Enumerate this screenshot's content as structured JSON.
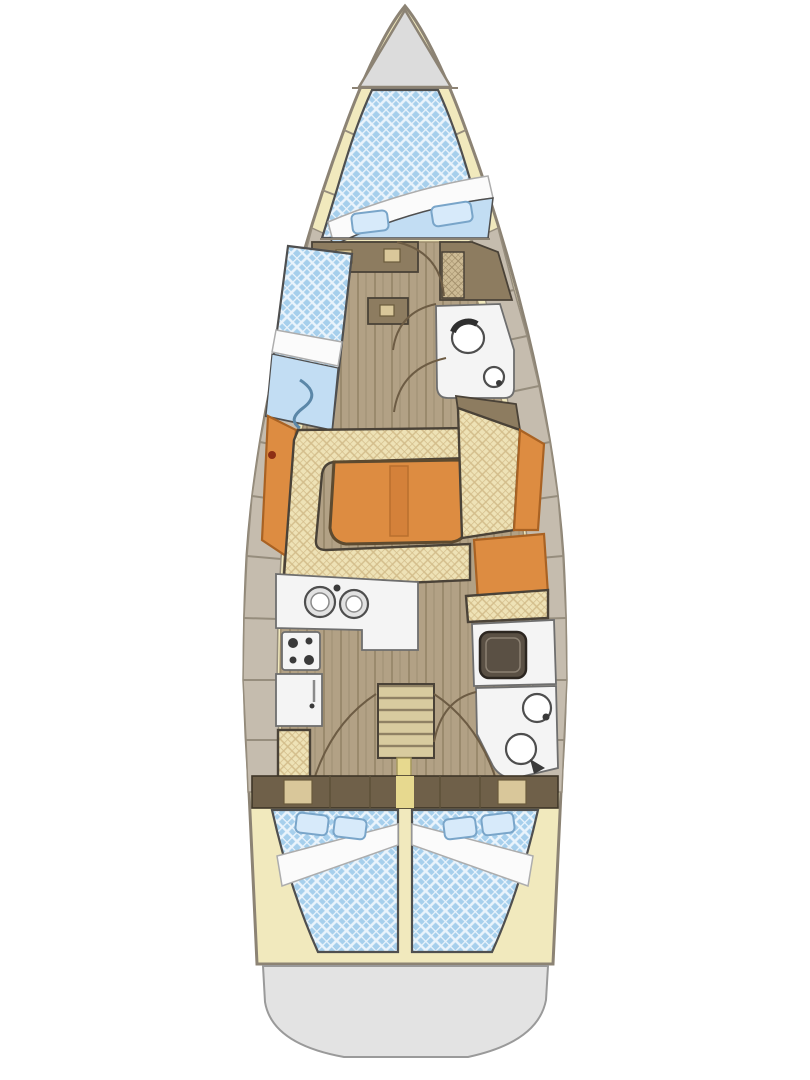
{
  "document": {
    "kind": "sailboat-interior-floor-plan",
    "orientation": "bow-up",
    "visible_text": []
  },
  "colors": {
    "deck_yellow": "#f1e9bd",
    "hull_outline": "#8c8374",
    "side_deck_gray": "#c5bcae",
    "side_deck_line": "#968d7d",
    "anchor_gray": "#dcdcdc",
    "transom_gray": "#e3e3e3",
    "wood_floor": "#b2a185",
    "wood_line": "#9a8a6d",
    "steps_base": "#d8cb9f",
    "steps_line": "#8f8164",
    "blue_base": "#a6cfec",
    "blue_line": "#eaf4fc",
    "blue_soft": "#c2ddf3",
    "pillow_fill": "#d7eafa",
    "pillow_line": "#79a5c9",
    "tan_base": "#eee2b6",
    "tan_line": "#d3bd8b",
    "orange": "#dd8c41",
    "orange_dark": "#a96223",
    "furniture_brown": "#8d7c60",
    "brown_dark": "#4a4237",
    "bulkhead_brown": "#6f6049",
    "locker_tan": "#d9c79a",
    "fixture_white": "#f4f4f4",
    "fixture_line": "#6e6e6e",
    "dark": "#3a3a3a",
    "bedding_white": "#fbfbfb",
    "mast_yellow": "#e7d98f",
    "door_arc": "#6d5c44",
    "outline_dark": "#4f4f4f"
  },
  "regions": [
    {
      "id": "anchor-locker",
      "position": "bow tip"
    },
    {
      "id": "v-berth",
      "position": "forward cabin double berth"
    },
    {
      "id": "port-single-berth",
      "position": "port forward"
    },
    {
      "id": "forward-head",
      "position": "starboard mid-forward"
    },
    {
      "id": "salon",
      "position": "midship port U-settee with table"
    },
    {
      "id": "starboard-settee",
      "position": "midship starboard"
    },
    {
      "id": "galley",
      "position": "port aft of salon"
    },
    {
      "id": "companionway",
      "position": "centerline aft"
    },
    {
      "id": "nav-station",
      "position": "starboard aft"
    },
    {
      "id": "aft-head",
      "position": "starboard aft"
    },
    {
      "id": "aft-cabin-port",
      "position": "port quarter double berth"
    },
    {
      "id": "aft-cabin-starboard",
      "position": "starboard quarter double berth"
    },
    {
      "id": "transom",
      "position": "stern swim platform"
    }
  ],
  "fixtures": [
    "double-sink",
    "stove-burners",
    "fridge",
    "companionway-steps",
    "chart-table",
    "toilet",
    "hand-basin",
    "salon-folding-table",
    "bed-pillows",
    "bed-blanket-bands",
    "door-swing-arcs"
  ]
}
